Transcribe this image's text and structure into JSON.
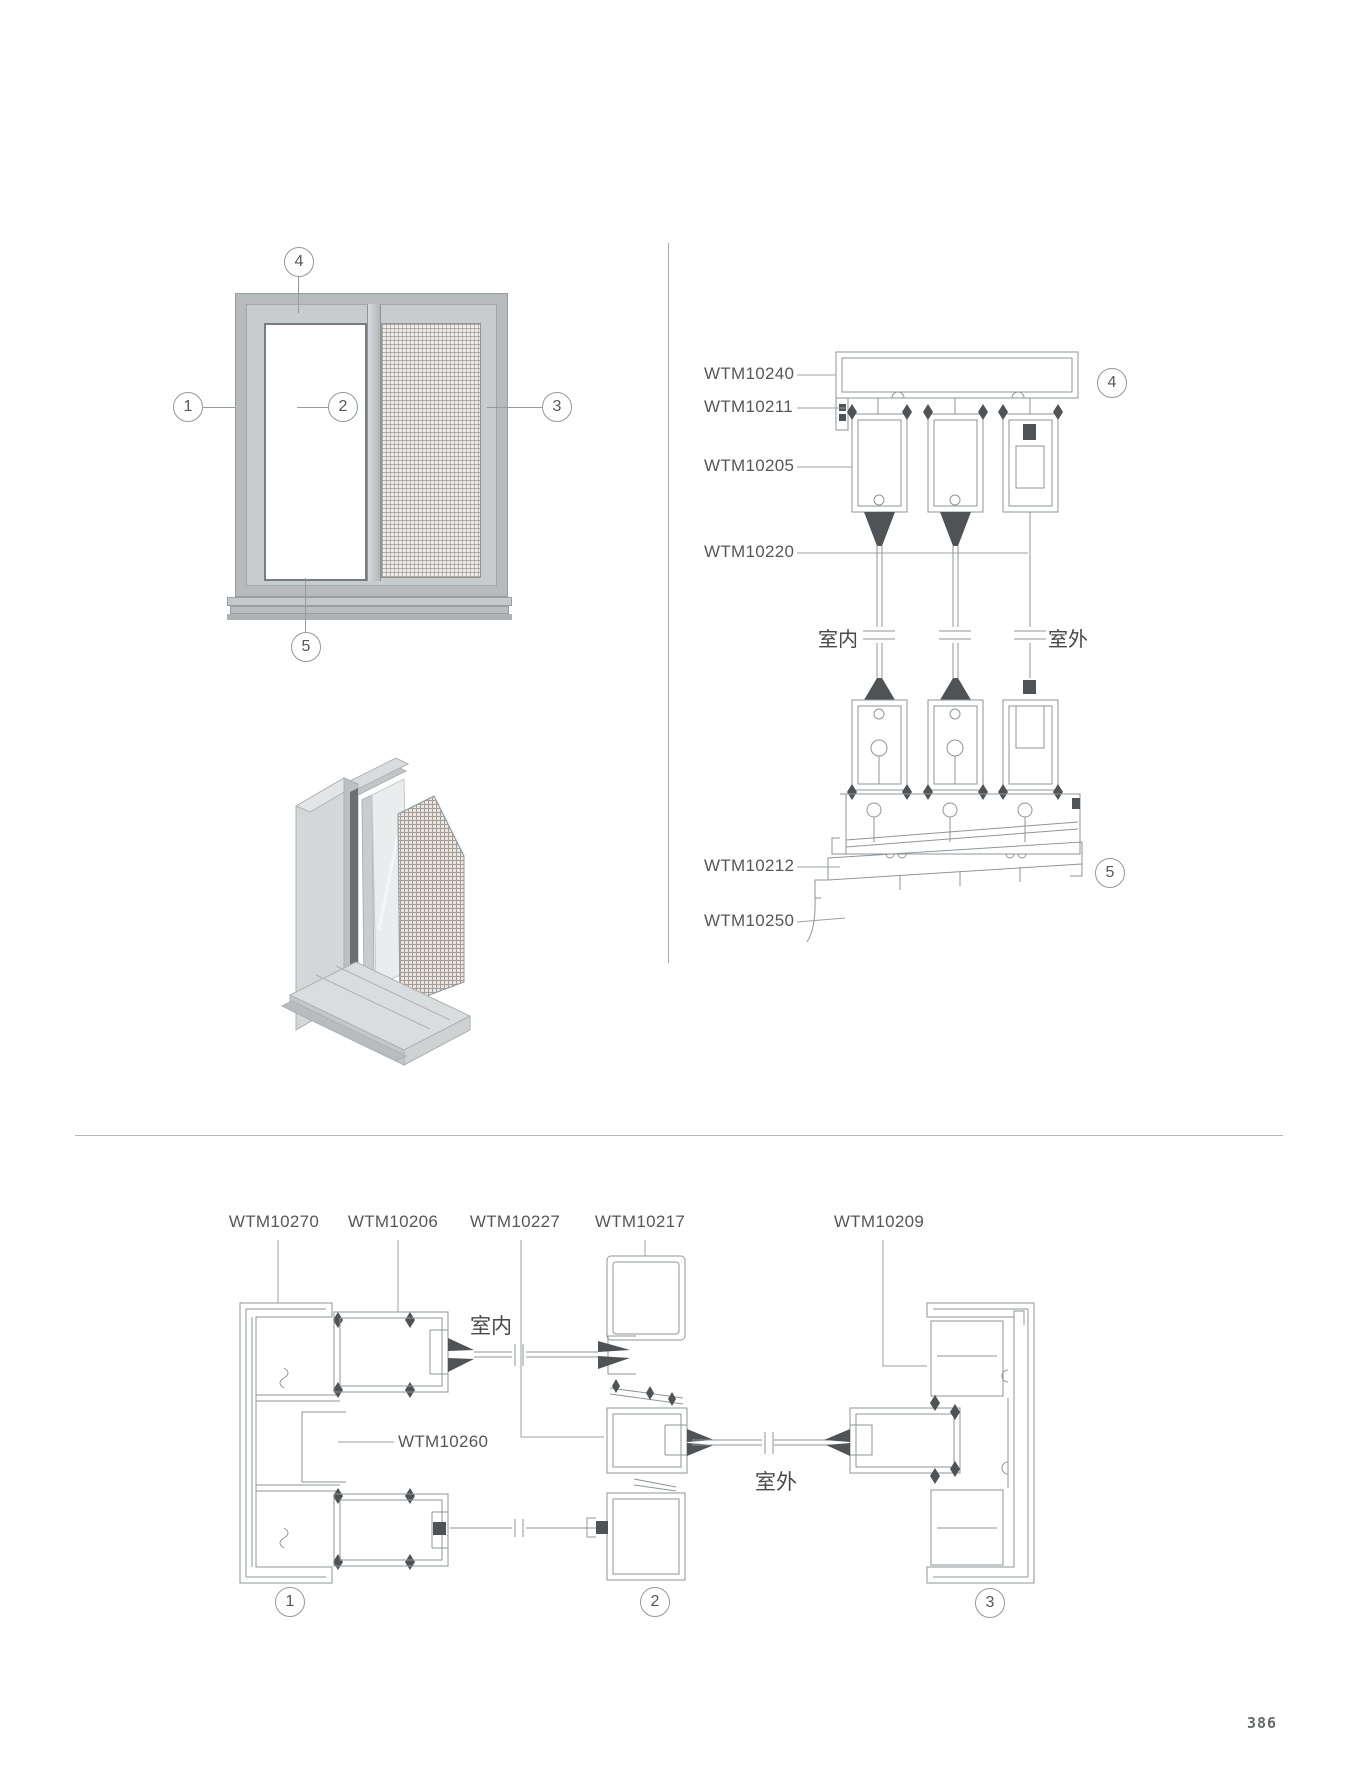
{
  "page_number": "386",
  "callouts": {
    "c1": "1",
    "c2": "2",
    "c3": "3",
    "c4": "4",
    "c5": "5"
  },
  "vertical_section": {
    "labels": [
      "WTM10240",
      "WTM10211",
      "WTM10205",
      "WTM10220",
      "WTM10212",
      "WTM10250"
    ],
    "indoor_label": "室内",
    "outdoor_label": "室外"
  },
  "horizontal_section": {
    "top_labels": [
      "WTM10270",
      "WTM10206",
      "WTM10227",
      "WTM10217",
      "WTM10209"
    ],
    "mid_label": "WTM10260",
    "indoor_label": "室内",
    "outdoor_label": "室外"
  },
  "colors": {
    "line": "#8f959a",
    "leader": "#9aa0a3",
    "dark_fill": "#4f5356",
    "label_text": "#55575a"
  }
}
